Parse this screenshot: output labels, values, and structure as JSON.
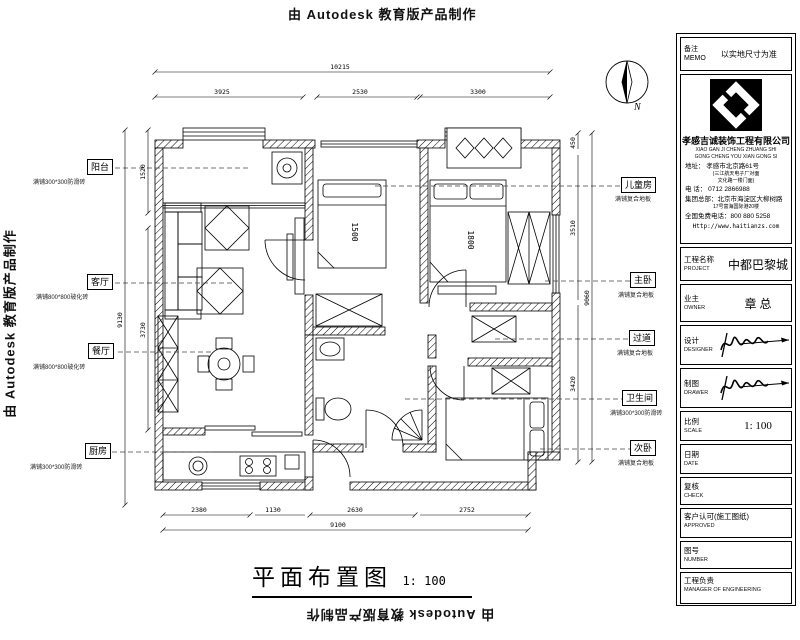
{
  "watermark": {
    "text": "由 Autodesk 教育版产品制作"
  },
  "plan": {
    "title": "平面布置图",
    "scale_text": "1: 100",
    "north_label": "N",
    "beds": {
      "child": "1500",
      "master": "1800"
    },
    "rooms": [
      {
        "name": "阳台",
        "finish": "满铺300*300防滑砖"
      },
      {
        "name": "客厅",
        "finish": "满铺800*800玻化砖"
      },
      {
        "name": "餐厅",
        "finish": "满铺800*800玻化砖"
      },
      {
        "name": "厨房",
        "finish": "满铺300*300防滑砖"
      },
      {
        "name": "儿童房",
        "finish": "满铺复合地板"
      },
      {
        "name": "主卧",
        "finish": "满铺复合地板"
      },
      {
        "name": "过道",
        "finish": "满铺复合地板"
      },
      {
        "name": "卫生间",
        "finish": "满铺300*300防滑砖"
      },
      {
        "name": "次卧",
        "finish": "满铺复合地板"
      }
    ],
    "dims": {
      "top_overall": "10215",
      "top": [
        "3925",
        "2530",
        "3300"
      ],
      "bottom": [
        "2380",
        "1130",
        "2630",
        "2752"
      ],
      "bottom_overall": "9100",
      "left": [
        "1520",
        "3730"
      ],
      "left_overall": "9130",
      "right": [
        "450",
        "3510",
        "3420"
      ],
      "right_overall": "9060"
    }
  },
  "title_block": {
    "memo": {
      "cn": "备注",
      "en": "MEMO",
      "value": "以实地尺寸为准"
    },
    "company": {
      "name": "孝感吉诚装饰工程有限公司",
      "pinyin1": "XIAO GAN JI CHENG ZHUANG SHI",
      "pinyin2": "GONG CHENG YOU XIAN GONG SI",
      "address": "地址：  孝感市北京路61号",
      "address_note1": "(三江航天电子厂对面",
      "address_note2": "文化路一楼门面)",
      "phone": "电  话：  0712 2866988",
      "hq1": "集团总部：北京市海淀区大柳树路",
      "hq2": "17号富海国际港20楼",
      "hotline": "全国免费电话：800 880 5258",
      "website": "Http://www.haitianzs.com"
    },
    "fields": [
      {
        "cn": "工程名称",
        "en": "PROJECT",
        "value": "中都巴黎城"
      },
      {
        "cn": "业主",
        "en": "OWNER",
        "value": "章 总"
      },
      {
        "cn": "设计",
        "en": "DESIGNER",
        "value": ""
      },
      {
        "cn": "制图",
        "en": "DRAWER",
        "value": ""
      },
      {
        "cn": "比例",
        "en": "SCALE",
        "value": "1:  100"
      },
      {
        "cn": "日期",
        "en": "DATE",
        "value": ""
      },
      {
        "cn": "复核",
        "en": "CHECK",
        "value": ""
      },
      {
        "cn": "客户认可(施工图纸)",
        "en": "APPROVED",
        "value": ""
      },
      {
        "cn": "图号",
        "en": "NUMBER",
        "value": ""
      },
      {
        "cn": "工程负责",
        "en": "MANAGER OF ENGINEERING",
        "value": ""
      }
    ]
  }
}
